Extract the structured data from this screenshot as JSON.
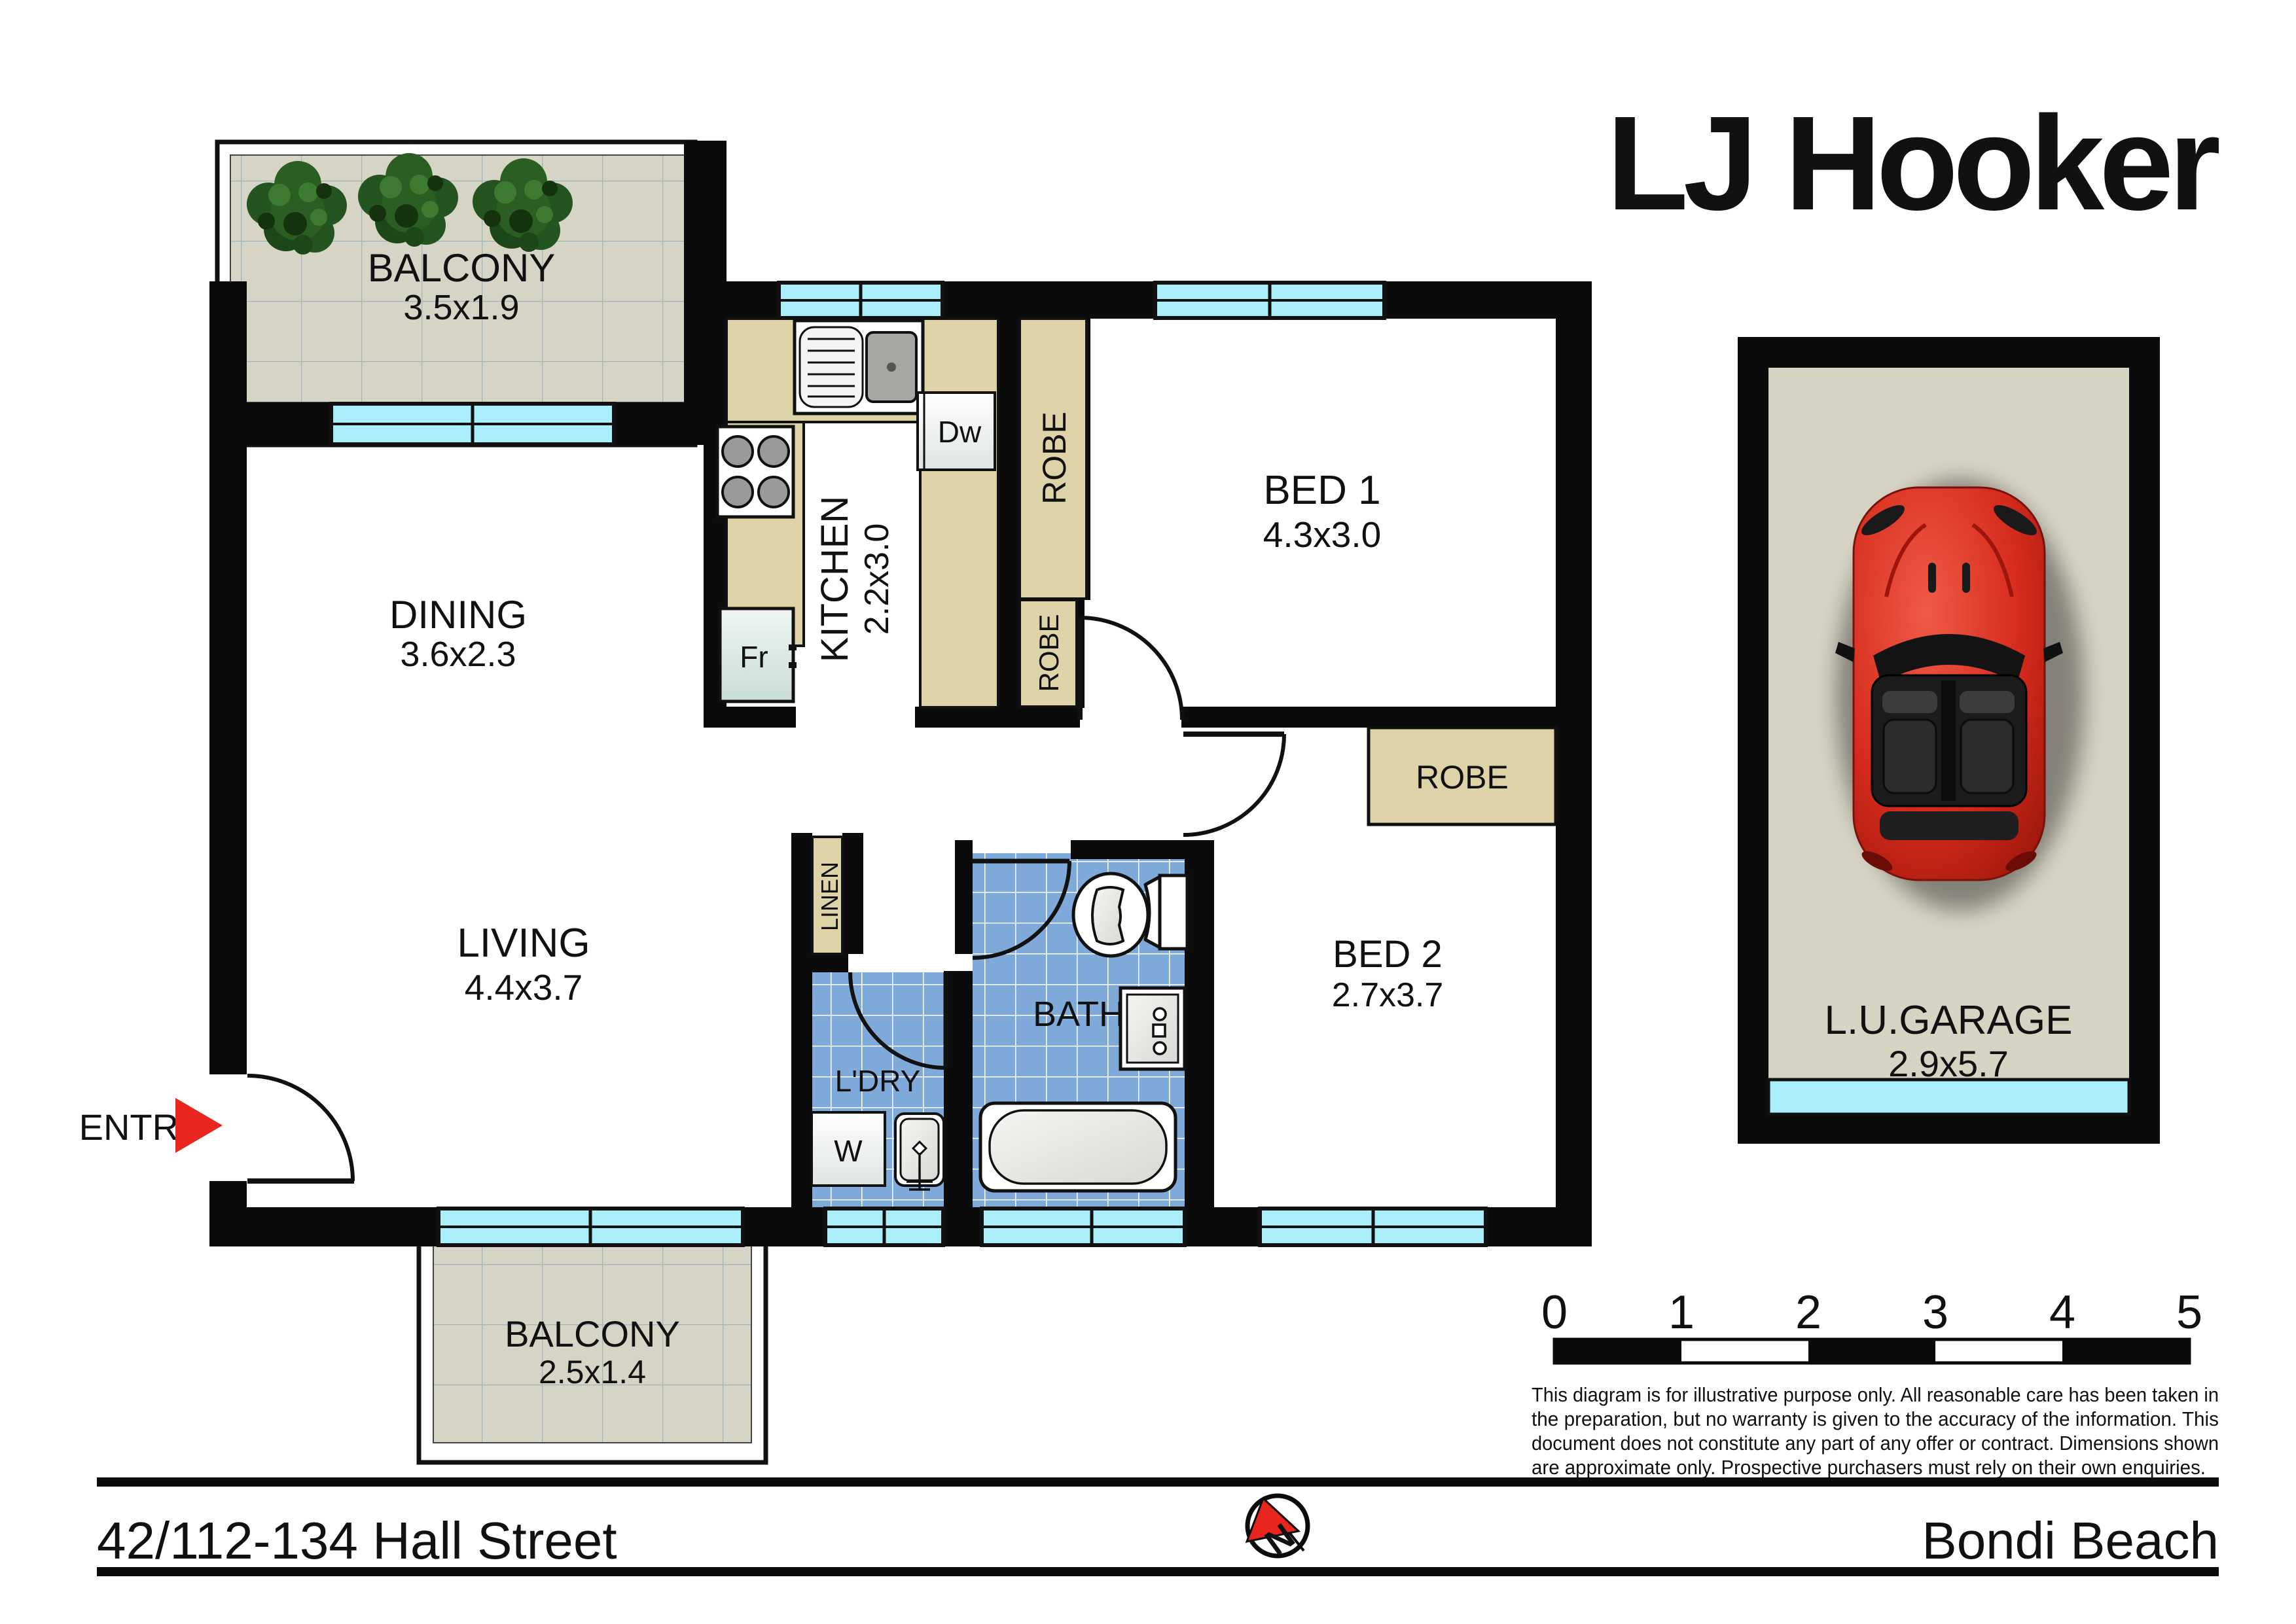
{
  "brand": {
    "name": "LJ Hooker"
  },
  "plan": {
    "rooms": {
      "balcony_top": {
        "name": "BALCONY",
        "dims": "3.5x1.9"
      },
      "dining": {
        "name": "DINING",
        "dims": "3.6x2.3"
      },
      "kitchen": {
        "name": "KITCHEN",
        "dims": "2.2x3.0"
      },
      "bed1": {
        "name": "BED 1",
        "dims": "4.3x3.0"
      },
      "living": {
        "name": "LIVING",
        "dims": "4.4x3.7"
      },
      "bath": {
        "name": "BATH"
      },
      "ldry": {
        "name": "L'DRY"
      },
      "bed2": {
        "name": "BED 2",
        "dims": "2.7x3.7"
      },
      "balcony_bottom": {
        "name": "BALCONY",
        "dims": "2.5x1.4"
      }
    },
    "labels": {
      "robe": "ROBE",
      "linen": "LINEN",
      "entry": "ENTRY",
      "fridge": "Fr",
      "dishwasher": "Dw",
      "washer": "W"
    }
  },
  "garage": {
    "name": "L.U.GARAGE",
    "dims": "2.9x5.7"
  },
  "scale": {
    "ticks": [
      "0",
      "1",
      "2",
      "3",
      "4",
      "5"
    ]
  },
  "disclaimer": [
    "This diagram is for illustrative purpose only. All reasonable care has been taken in",
    "the preparation, but no warranty is given to the accuracy of the information. This",
    "document does not constitute any part of any offer or contract. Dimensions shown",
    "are approximate only. Prospective purchasers must rely on their own enquiries."
  ],
  "footer": {
    "address": "42/112-134 Hall Street",
    "suburb": "Bondi Beach",
    "north": "N"
  },
  "colors": {
    "wall": "#0b0b0b",
    "window": "#a9eef9",
    "joinery_tan": "#ddd2a8",
    "tile_beige": "#d6d4c4",
    "tile_blue": "#7fa9d8",
    "accent_red": "#e8251f",
    "car_red": "#d62b1c"
  }
}
